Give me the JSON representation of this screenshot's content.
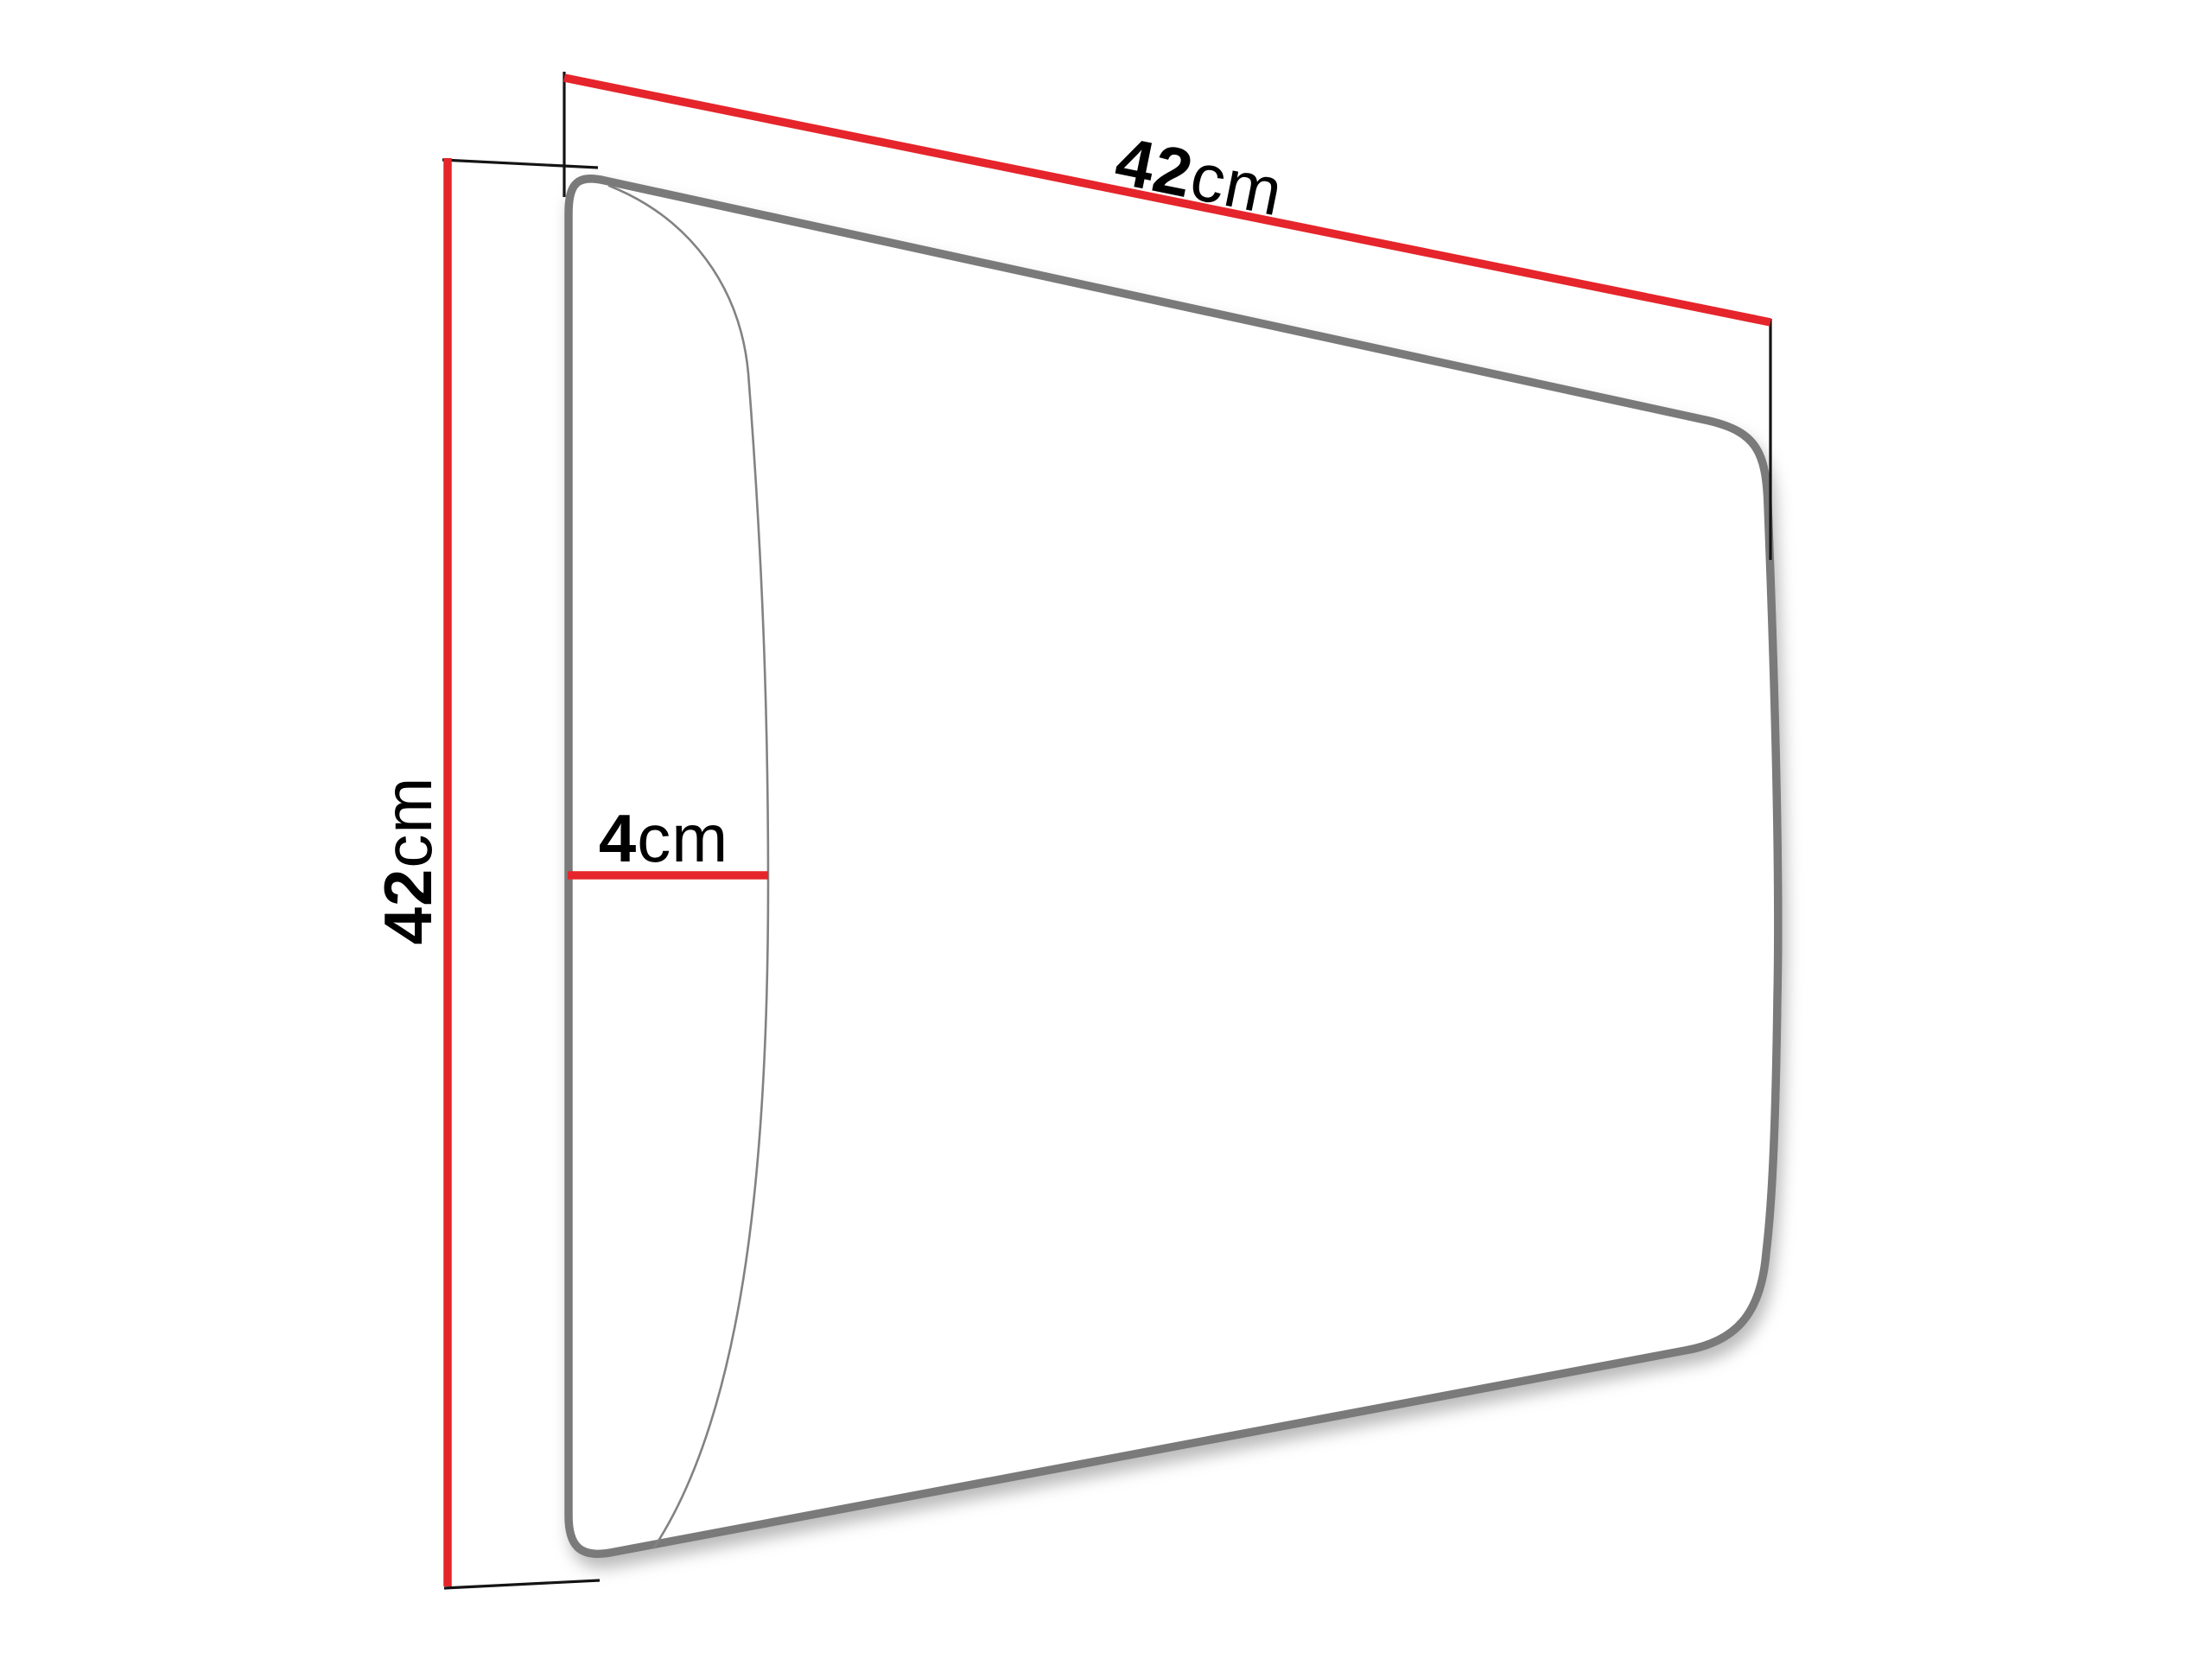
{
  "figure": {
    "type": "dimension-diagram",
    "subject": "upholstered wall panel perspective drawing",
    "background": "#ffffff"
  },
  "colors": {
    "dimension_line": "#e5252b",
    "extension_line": "#141414",
    "outline": "#7a7a7a",
    "bulge_curve": "#828282",
    "text": "#000000"
  },
  "dimensions": {
    "width": {
      "value": "42",
      "unit": "cm"
    },
    "height": {
      "value": "42",
      "unit": "cm"
    },
    "depth": {
      "value": "4",
      "unit": "cm"
    }
  }
}
